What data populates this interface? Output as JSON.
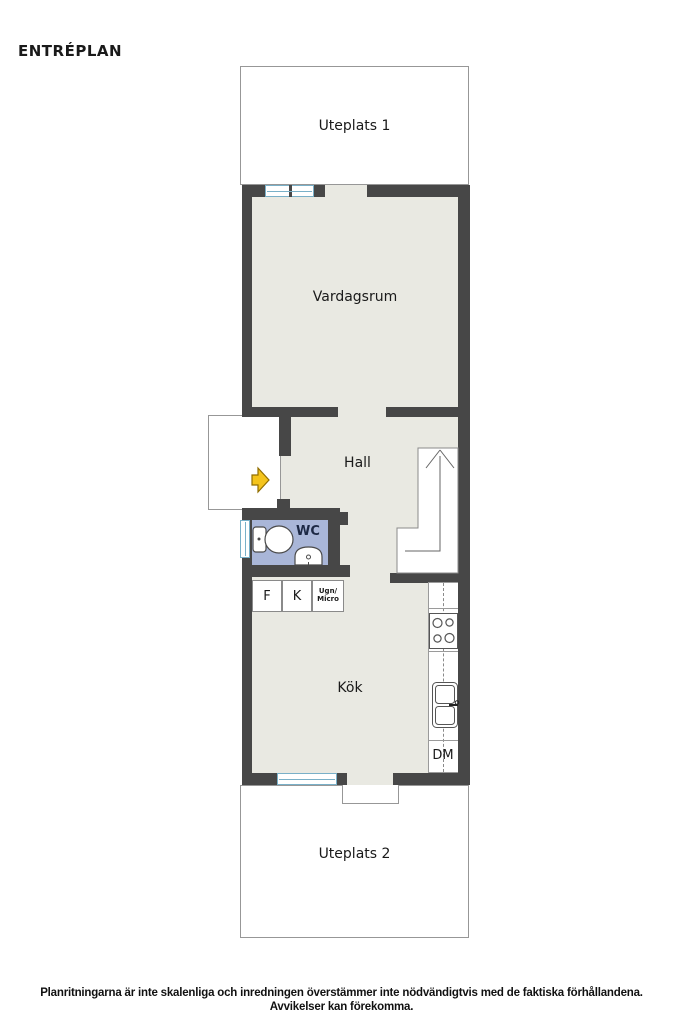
{
  "page": {
    "title": "ENTRÉPLAN"
  },
  "rooms": {
    "uteplats1": "Uteplats 1",
    "vardagsrum": "Vardagsrum",
    "hall": "Hall",
    "wc": "WC",
    "kok": "Kök",
    "uteplats2": "Uteplats 2"
  },
  "kitchen": {
    "freezer": "F",
    "fridge": "K",
    "oven_line1": "Ugn/",
    "oven_line2": "Micro",
    "dishwasher": "DM"
  },
  "icons": {
    "entry_arrow": "right-arrow",
    "stairs_direction": "up-arrow",
    "wc_fixtures": [
      "toilet",
      "washbasin"
    ],
    "kitchen_fixtures": [
      "stove-4-burners",
      "double-sink"
    ]
  },
  "colors": {
    "wall": "#474747",
    "floor": "#e9e9e2",
    "wc_floor": "#a9b6d8",
    "window_frame": "#79b0c8",
    "outline": "#979797",
    "fixture": "#4a4a4a",
    "arrow": "#f4c41d",
    "arrow_outline": "#916e00",
    "ink": "#1a1a1a",
    "wc_ink": "#1d2945"
  },
  "footer": {
    "line1": "Planritningarna är inte skalenliga och inredningen överstämmer inte nödvändigtvis med de faktiska förhållandena.",
    "line2": "Avvikelser kan förekomma."
  }
}
